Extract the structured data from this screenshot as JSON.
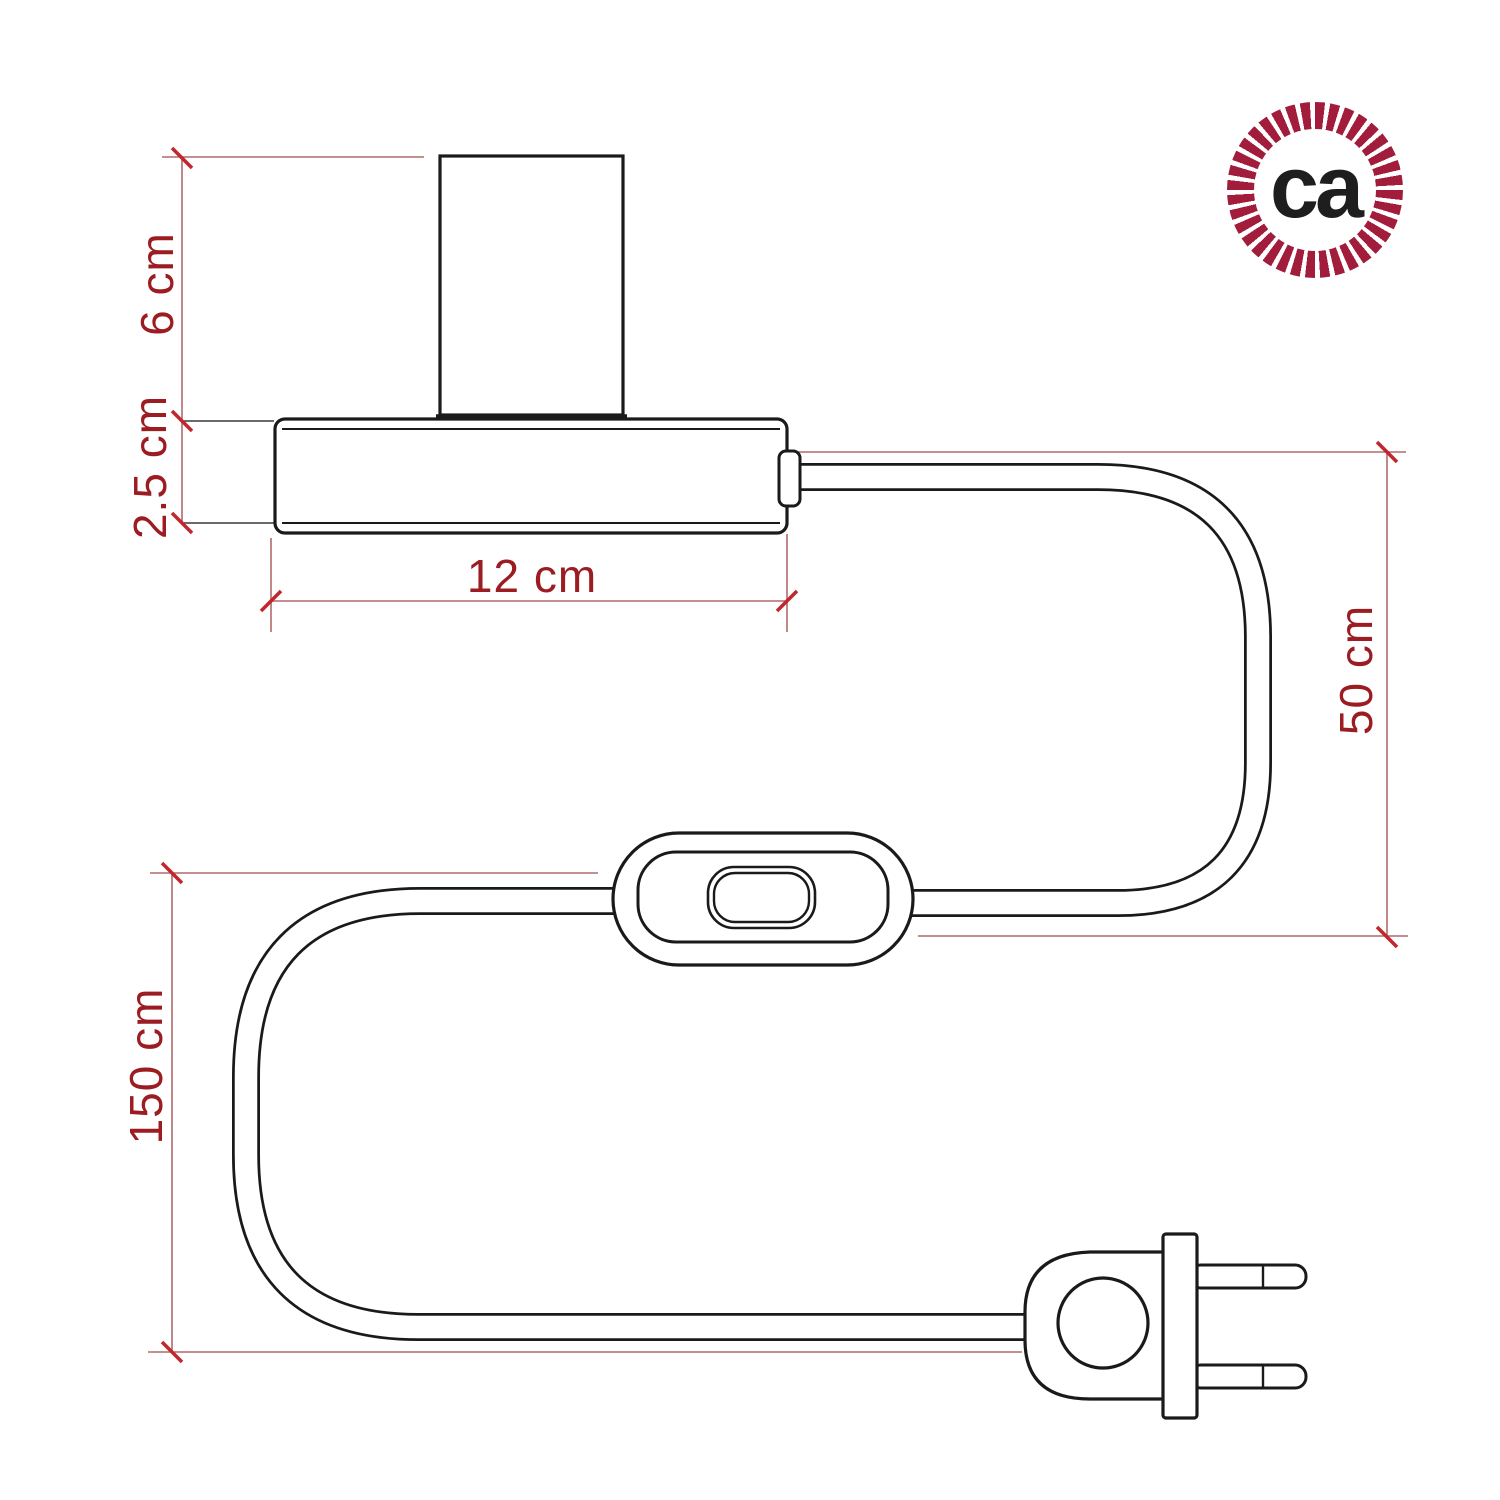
{
  "diagram": {
    "type": "product-dimension-drawing",
    "subject": "table-lamp cord set with lamp holder, inline switch and two-prong plug",
    "labels": {
      "socket_height": "6 cm",
      "base_height": "2.5 cm",
      "base_width": "12 cm",
      "cable_upper": "50 cm",
      "cable_total": "150 cm"
    },
    "colors": {
      "outline": "#1a1a1a",
      "dimension_text": "#9b1c21",
      "dimension_line": "#b06a6a",
      "tick_mark": "#c1272d",
      "logo_rope": "#a21c3c",
      "logo_text": "#1e1e1e"
    }
  },
  "logo": {
    "monogram": "ca"
  }
}
